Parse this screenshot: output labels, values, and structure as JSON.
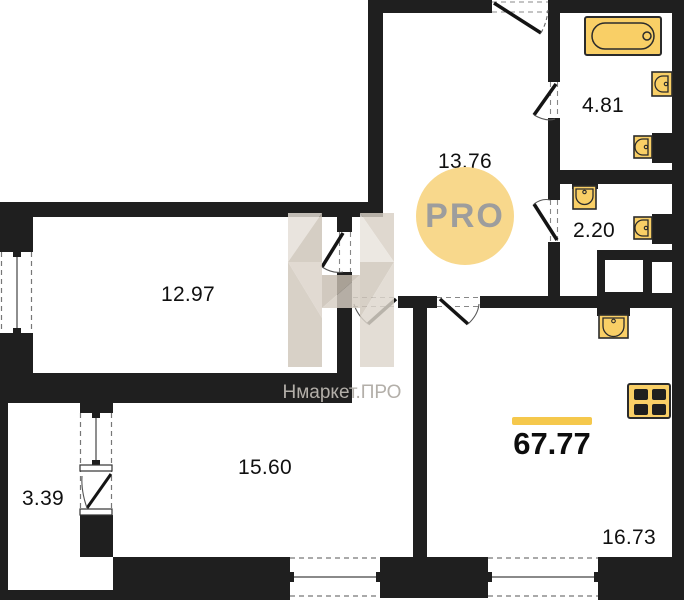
{
  "watermark": {
    "logo_text": "PRO",
    "brand_text": "Нмаркет.ПРО"
  },
  "total_area": "67.77",
  "rooms": {
    "hall": "13.76",
    "bathroom": "4.81",
    "wc": "2.20",
    "bedroom": "12.97",
    "bedroom2": "15.60",
    "balcony": "3.39",
    "living": "16.73"
  },
  "icons": {
    "bathtub": "bathtub-icon",
    "sink": "sink-icon",
    "stove": "stove-icon",
    "vent_shaft": "vent-shaft",
    "door_swing": "door-swing",
    "window": "window"
  },
  "colors": {
    "wall": "#1f1f1f",
    "fixture_fill": "#F9CF66",
    "fixture_stroke": "#2b2b2b",
    "accent_bar": "#F5C84C",
    "pro_circle": "#F8D88C",
    "pro_text": "#9D9D9D",
    "watermark_beige": "#D6CEC3",
    "watermark_text": "#B3AFA9"
  }
}
